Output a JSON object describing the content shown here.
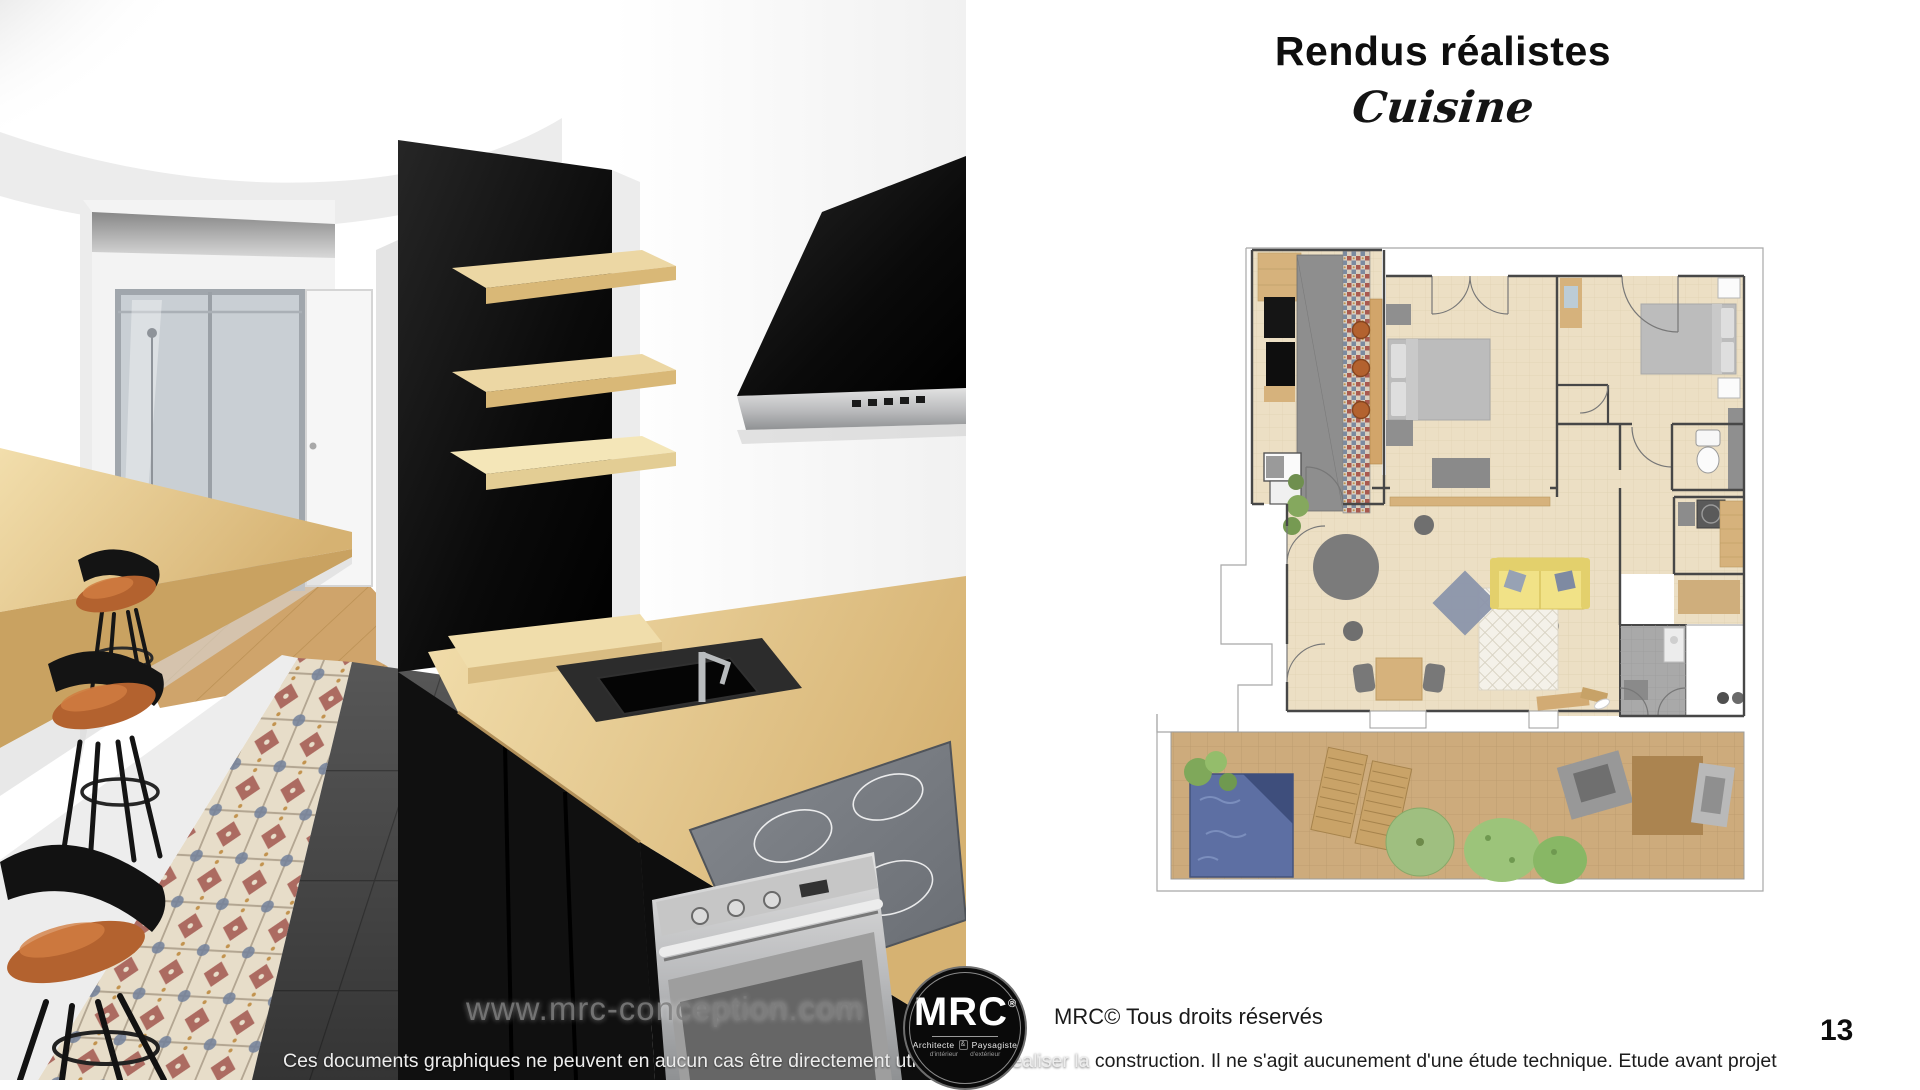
{
  "header": {
    "title": "Rendus réalistes",
    "subtitle": "Cuisine"
  },
  "footer": {
    "website": "www.mrc-conception.com",
    "copyright": "MRC© Tous droits réservés",
    "disclaimer_left": "Ces documents graphiques ne peuvent en aucun cas être directement utilisés pour réaliser la ",
    "disclaimer_right": "construction. Il ne s'agit aucunement d'une étude technique. Etude avant projet",
    "page_number": "13"
  },
  "logo": {
    "name": "MRC",
    "mark": "®",
    "tagline_left": "Architecte",
    "tagline_amp": "&",
    "tagline_right": "Paysagiste",
    "subline_left": "d'intérieur",
    "subline_right": "d'extérieur"
  },
  "theme": {
    "wood_light": "#ecd7a4",
    "wood_mid": "#d9b877",
    "stool_leather": "#b3622f",
    "cabinet_black": "#101010",
    "floor_grey": "#545454",
    "plan_floor_beige": "#ecdfc4",
    "terrace_deck": "#cdab7c",
    "sofa_yellow": "#f1e287",
    "pool_blue": "#5d6fa3",
    "plant_green": "#9cc47a"
  }
}
